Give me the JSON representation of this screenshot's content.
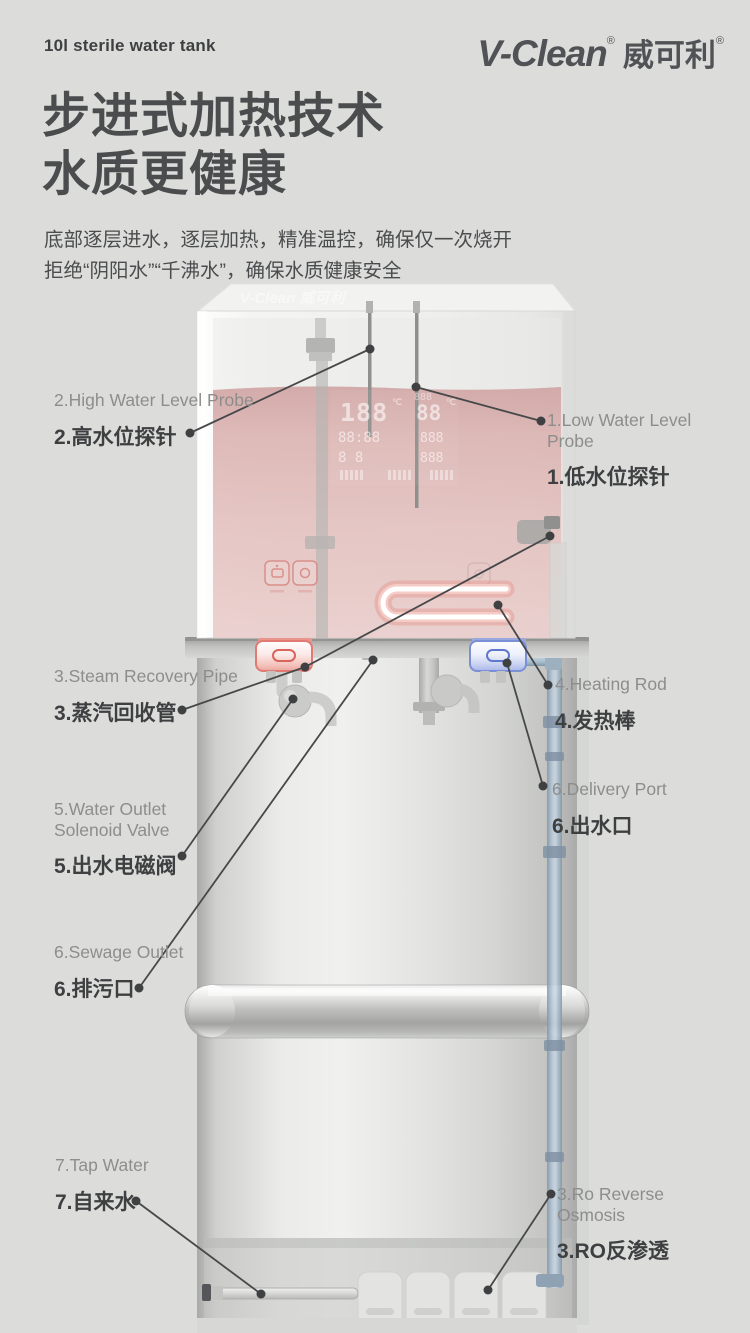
{
  "colors": {
    "background": "#dcdddb",
    "heading_text": "#4b4c4e",
    "label_en_text": "#8d8e8c",
    "label_zh_text": "#3e3f41",
    "leader_line": "#47484a",
    "water_pink": "#dfb9b7",
    "valve_hot_accent": "#d8645c",
    "valve_cold_accent": "#5f77cc",
    "pipe_blue": "#9db3c8"
  },
  "header": {
    "tagline": "10l sterile water tank",
    "brand_en": "V-Clean",
    "brand_cn": "威可利",
    "reg_mark": "®"
  },
  "hero": {
    "title_line1": "步进式加热技术",
    "title_line2": "水质更健康",
    "desc_line1": "底部逐层进水，逐层加热，精准温控，确保仅一次烧开",
    "desc_line2": "拒绝“阴阳水”“千沸水”，确保水质健康安全"
  },
  "diagram": {
    "watermark": "V-Clean 威可利",
    "display": {
      "temp_main": "188",
      "temp_main_unit": "℃",
      "temp_sub": "88",
      "temp_sub_unit": "℃",
      "clock": "88:88",
      "reading_a": "888",
      "reading_b": "8 8",
      "reading_c": "888"
    },
    "labels": {
      "high_probe": {
        "en": "2.High Water Level Probe",
        "zh": "2.高水位探针"
      },
      "low_probe": {
        "en": "1.Low Water Level Probe",
        "zh": "1.低水位探针"
      },
      "steam_pipe": {
        "en": "3.Steam Recovery Pipe",
        "zh": "3.蒸汽回收管"
      },
      "heating_rod": {
        "en": "4.Heating Rod",
        "zh": "4.发热棒"
      },
      "solenoid": {
        "en": "5.Water Outlet Solenoid Valve",
        "zh": "5.出水电磁阀"
      },
      "delivery": {
        "en": "6.Delivery Port",
        "zh": "6.出水口"
      },
      "sewage": {
        "en": "6.Sewage Outlet",
        "zh": "6.排污口"
      },
      "tap": {
        "en": "7.Tap Water",
        "zh": "7.自来水"
      },
      "ro": {
        "en": "3.Ro Reverse Osmosis",
        "zh": "3.RO反渗透"
      }
    }
  }
}
